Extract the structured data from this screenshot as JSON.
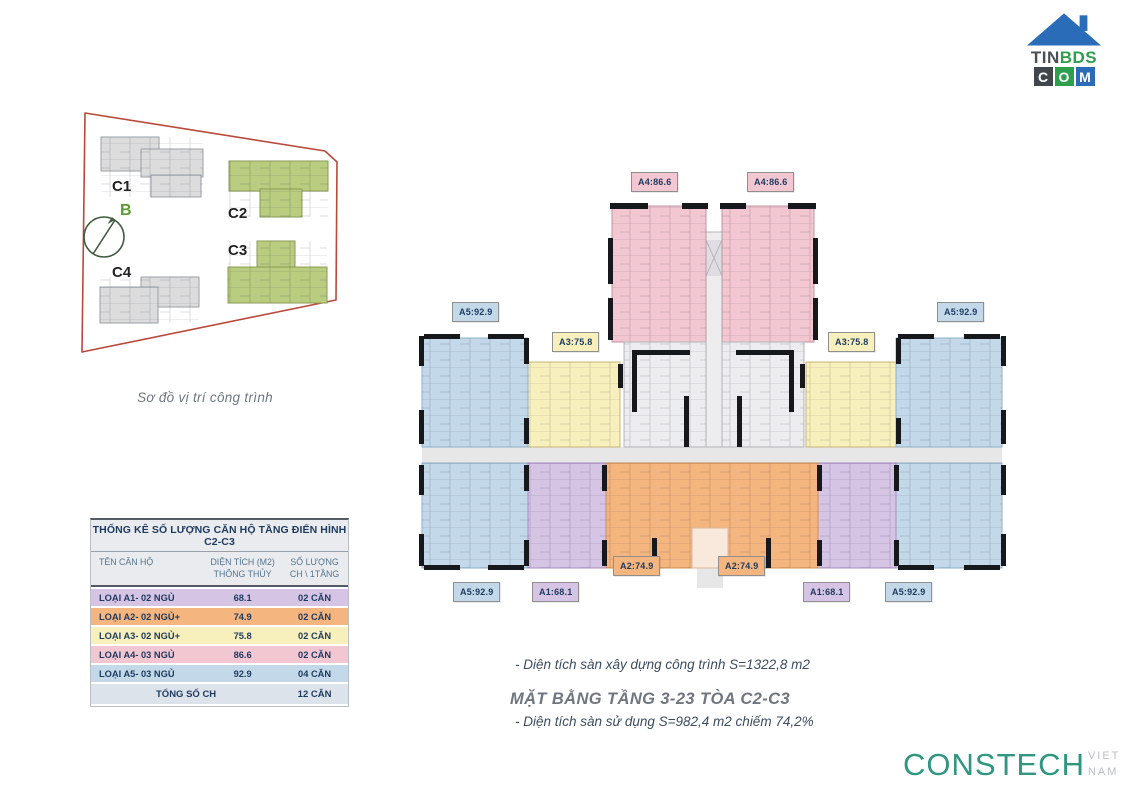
{
  "logo": {
    "line1_part1": "TIN",
    "line1_part2": "BDS",
    "block_c": "C",
    "block_o": "O",
    "block_m": "M"
  },
  "site_plan": {
    "buildings": [
      {
        "id": "C1"
      },
      {
        "id": "C2"
      },
      {
        "id": "C3"
      },
      {
        "id": "C4"
      }
    ],
    "compass_label": "B",
    "caption": "Sơ đồ vị trí công trình"
  },
  "table": {
    "title": "THỐNG KÊ SỐ LƯỢNG CĂN HỘ TẦNG ĐIỂN HÌNH C2-C3",
    "headers": {
      "name": "TÊN CĂN HỘ",
      "area_line1": "DIỆN TÍCH (M2)",
      "area_line2": "THÔNG THỦY",
      "count_line1": "SỐ LƯỢNG",
      "count_line2": "CH \\ 1TẦNG"
    },
    "rows": [
      {
        "name": "LOẠI A1- 02 NGỦ",
        "area": "68.1",
        "count": "02 CĂN"
      },
      {
        "name": "LOẠI A2- 02 NGỦ+",
        "area": "74.9",
        "count": "02 CĂN"
      },
      {
        "name": "LOẠI A3- 02 NGỦ+",
        "area": "75.8",
        "count": "02 CĂN"
      },
      {
        "name": "LOẠI A4- 03 NGỦ",
        "area": "86.6",
        "count": "02 CĂN"
      },
      {
        "name": "LOẠI A5- 03 NGỦ",
        "area": "92.9",
        "count": "04 CĂN"
      }
    ],
    "total": {
      "label": "TỔNG SỐ CH",
      "count": "12 CĂN"
    }
  },
  "floor_plan": {
    "labels": {
      "a1": "A1:68.1",
      "a2": "A2:74.9",
      "a3": "A3:75.8",
      "a4": "A4:86.6",
      "a5": "A5:92.9"
    },
    "notes": {
      "line1": "- Diện tích sàn xây dựng công trình S=1322,8 m2",
      "line2": "- Diện tích sàn sử dụng S=982,4 m2 chiếm 74,2%"
    },
    "caption": "MẶT BẰNG TẦNG 3-23 TÒA C2-C3"
  },
  "footer_logo": {
    "name": "CONSTECH",
    "country": "VIET NAM"
  },
  "colors": {
    "pink": "#F2C7D2",
    "blue": "#C3D9E9",
    "yellow": "#F7F0BC",
    "orange": "#F4B57F",
    "purple": "#D5C4E4",
    "navy": "#1E3A5F",
    "teal": "#2F9680",
    "red": "#B8493B",
    "greenbldg": "#B9CC80",
    "graybldg": "#DCDCDC"
  }
}
